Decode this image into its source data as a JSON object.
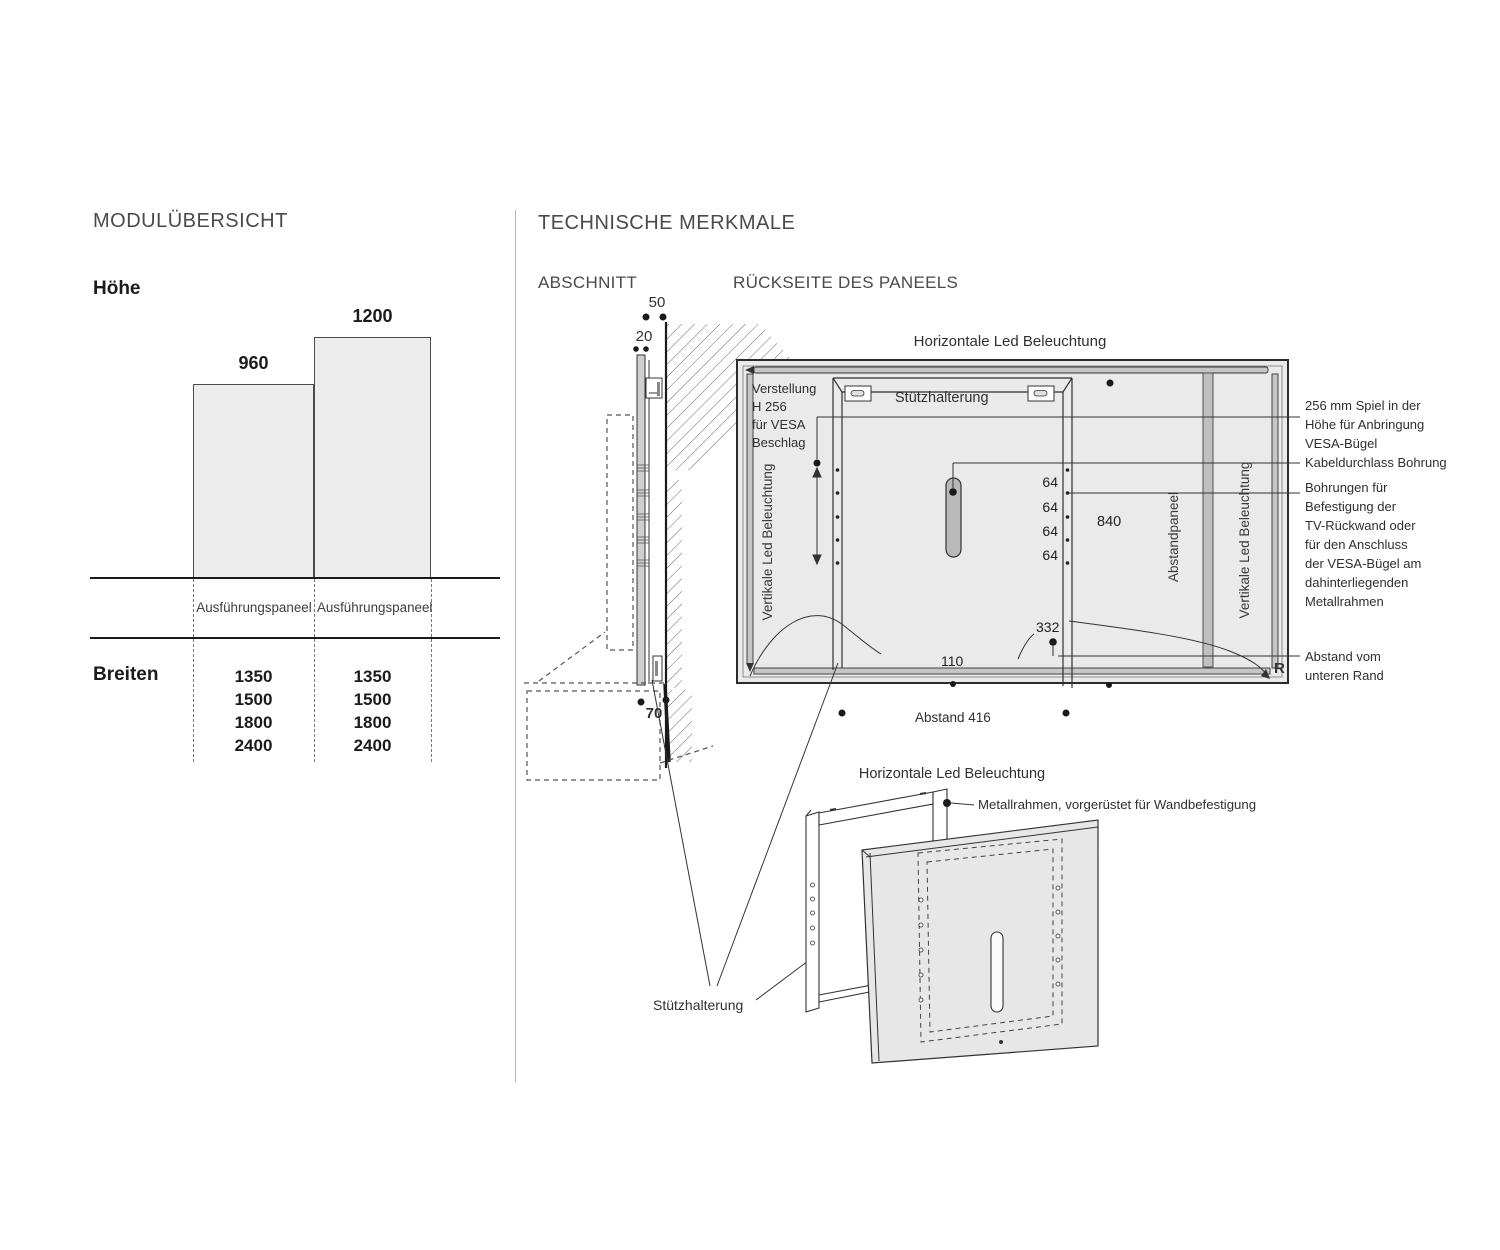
{
  "module_overview": {
    "title": "MODULÜBERSICHT",
    "height_label": "Höhe",
    "bar_small_value": "960",
    "bar_large_value": "1200",
    "col1_header": "Ausführungspaneel",
    "col2_header": "Ausführungspaneel",
    "widths_label": "Breiten",
    "col1_widths": [
      "1350",
      "1500",
      "1800",
      "2400"
    ],
    "col2_widths": [
      "1350",
      "1500",
      "1800",
      "2400"
    ]
  },
  "technical": {
    "title": "TECHNISCHE MERKMALE",
    "section_view": {
      "title": "ABSCHNITT",
      "dim_top": "50",
      "dim_gap": "20",
      "dim_bottom": "70"
    },
    "rear_view": {
      "title": "RÜCKSEITE DES PANEELS",
      "top_led_label": "Horizontale Led Beleuchtung",
      "left_led_label": "Vertikale Led Beleuchtung",
      "right_led_label": "Vertikale Led Beleuchtung",
      "spacer_label": "Abstandpaneel",
      "support_label": "Stützhalterung",
      "vesa_lines": [
        "Verstellung",
        "H 256",
        "für VESA",
        "Beschlag"
      ],
      "hole_gap": "64",
      "inner_height": "840",
      "bottom_offset": "332",
      "led_inset": "110",
      "spacing_label": "Abstand 416",
      "corner_label": "R"
    },
    "annotations": {
      "vesa_play": [
        "256 mm Spiel in der",
        "Höhe für Anbringung",
        "VESA-Bügel"
      ],
      "cable_hole": "Kabeldurchlass Bohrung",
      "mount_holes": [
        "Bohrungen für",
        "Befestigung der",
        "TV-Rückwand oder",
        "für den Anschluss",
        "der VESA-Bügel am",
        "dahinterliegenden",
        "Metallrahmen"
      ],
      "bottom_distance": [
        "Abstand vom",
        "unteren Rand"
      ]
    },
    "exploded_view": {
      "title": "Horizontale Led Beleuchtung",
      "frame_label": "Metallrahmen, vorgerüstet für Wandbefestigung",
      "support_label": "Stützhalterung"
    }
  }
}
